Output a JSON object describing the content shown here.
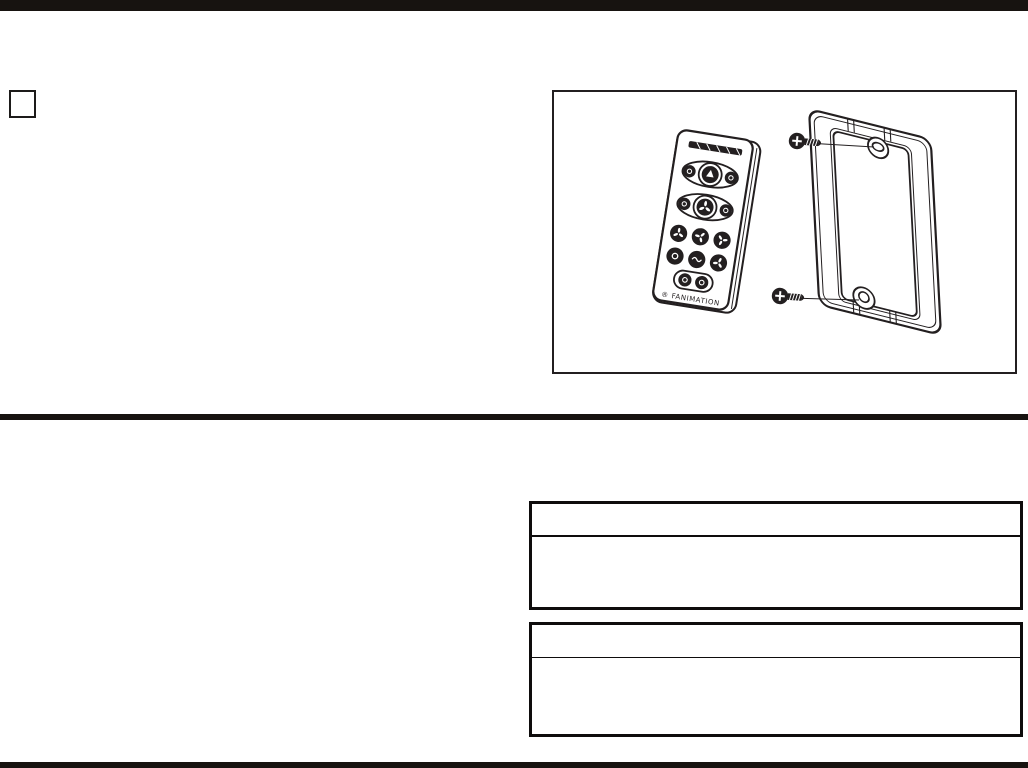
{
  "document": {
    "kind": "scanned instruction-manual page",
    "background_color": "#ffffff",
    "ink_color": "#231f20",
    "bar_color": "#171310"
  },
  "step_box": {
    "label": ""
  },
  "illustration": {
    "description": "Line drawing of a handheld remote control beside a wall-mount cradle plate with two mounting screws",
    "remote": {
      "brand_text": "® FANIMATION"
    },
    "cradle": {
      "screw_count": "2"
    }
  },
  "panels": [
    {
      "header_text": "",
      "body_text": ""
    },
    {
      "header_text": "",
      "body_text": ""
    }
  ]
}
